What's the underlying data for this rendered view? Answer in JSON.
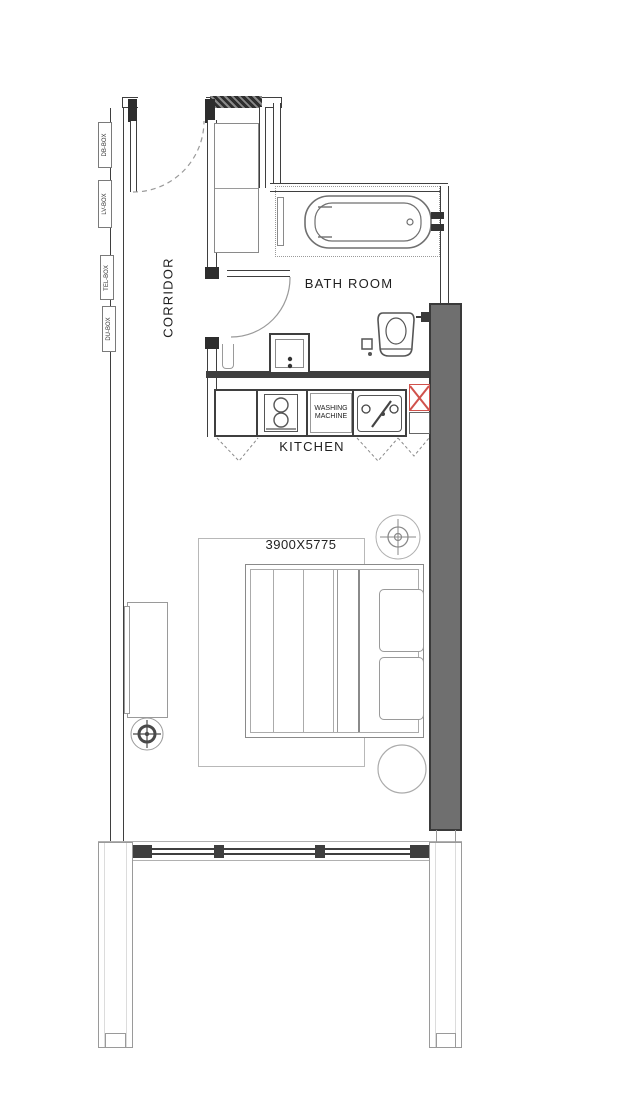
{
  "labels": {
    "corridor": "CORRIDOR",
    "bath_room": "BATH ROOM",
    "kitchen": "KITCHEN",
    "washing_machine_line1": "WASHING",
    "washing_machine_line2": "MACHINE",
    "room_dimension": "3900X5775"
  },
  "utility_boxes": [
    {
      "label": "DB-BOX"
    },
    {
      "label": "LV-BOX"
    },
    {
      "label": "TEL-BOX"
    },
    {
      "label": "DU-BOX"
    }
  ],
  "colors": {
    "wall_line": "#3f3f3f",
    "fixture_line": "#8a8a8a",
    "shaft_fill": "#6f6f6f",
    "duct_marker_red": "#d0524c"
  },
  "fixtures": [
    "entry-door",
    "wardrobe",
    "bathtub",
    "toilet",
    "washbasin",
    "bathroom-door",
    "stove",
    "washing-machine",
    "kitchen-sink",
    "duct-x-marker",
    "bed",
    "pillow",
    "rug",
    "desk",
    "side-table",
    "ceiling-light",
    "window-wall",
    "column"
  ]
}
